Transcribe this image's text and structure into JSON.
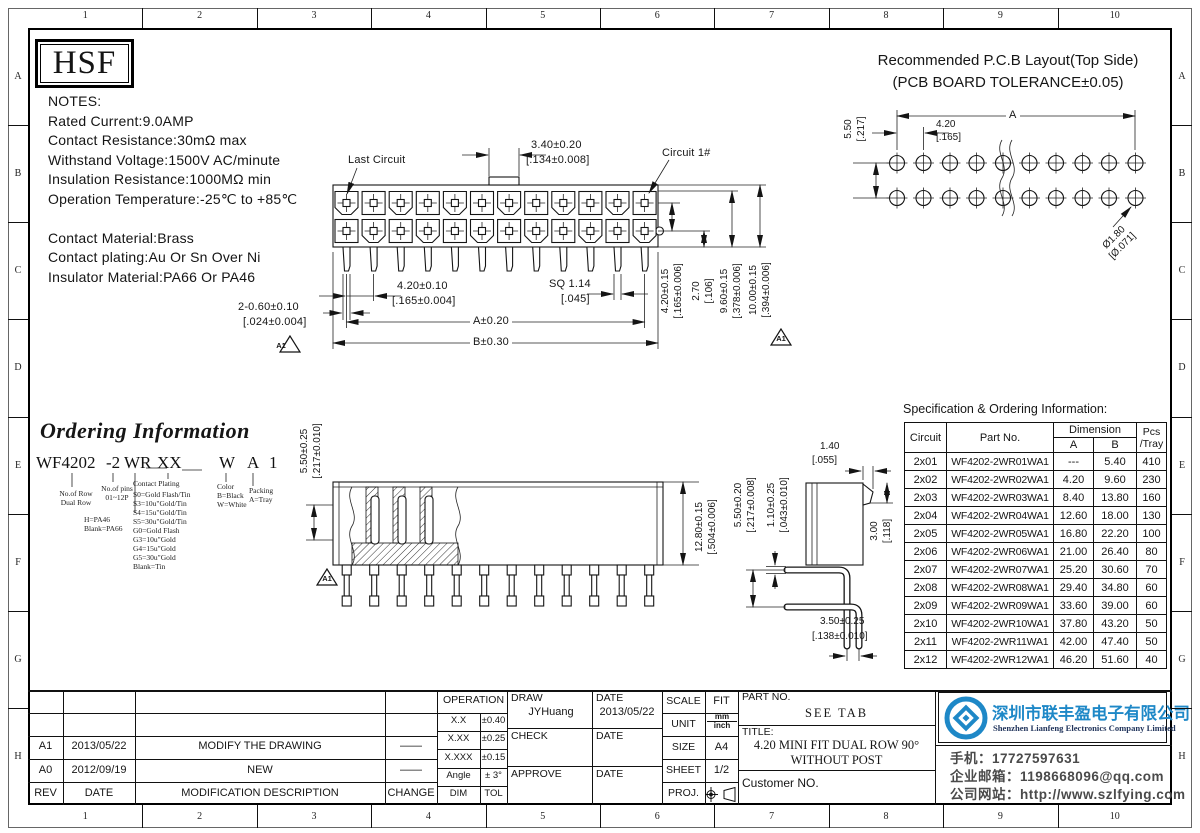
{
  "sheet": {
    "columns": [
      "1",
      "2",
      "3",
      "4",
      "5",
      "6",
      "7",
      "8",
      "9",
      "10"
    ],
    "rows": [
      "A",
      "B",
      "C",
      "D",
      "E",
      "F",
      "G",
      "H"
    ]
  },
  "logo_text": "HSF",
  "notes": {
    "lines": [
      "NOTES:",
      "Rated Current:9.0AMP",
      "Contact Resistance:30mΩ max",
      "Withstand Voltage:1500V AC/minute",
      "Insulation Resistance:1000MΩ min",
      "Operation Temperature:-25℃ to +85℃",
      "",
      "Contact Material:Brass",
      "Contact plating:Au Or Sn Over Ni",
      "Insulator Material:PA66 Or PA46"
    ]
  },
  "pcb": {
    "title_line1": "Recommended P.C.B Layout(Top Side)",
    "title_line2": "(PCB BOARD TOLERANCE±0.05)",
    "dim_v": "5.50",
    "dim_v_in": "[.217]",
    "dim_pitch": "4.20",
    "dim_pitch_in": "[.165]",
    "dim_a": "A",
    "dim_hole": "Ø1.80",
    "dim_hole_in": "[Ø.071]"
  },
  "front_view": {
    "last_circuit": "Last Circuit",
    "circuit1": "Circuit 1#",
    "dim_tab": "3.40±0.20",
    "dim_tab_in": "[.134±0.008]",
    "dim_pitch": "4.20±0.10",
    "dim_pitch_in": "[.165±0.004]",
    "dim_sq": "SQ 1.14",
    "dim_sq_in": "[.045]",
    "dim_a": "A±0.20",
    "dim_b": "B±0.30",
    "dim_pin": "2-0.60±0.10",
    "dim_pin_in": "[.024±0.004]",
    "rev_flag": "A1",
    "right_dims": [
      {
        "mm": "4.20±0.15",
        "in": "[.165±0.006]"
      },
      {
        "mm": "2.70",
        "in": "[.106]"
      },
      {
        "mm": "9.60±0.15",
        "in": "[.378±0.006]"
      },
      {
        "mm": "10.00±0.15",
        "in": "[.394±0.006]"
      }
    ]
  },
  "ordering": {
    "title": "Ordering Information",
    "code": [
      "WF4202",
      "-2",
      "WR",
      "XX",
      "W",
      "A",
      "1"
    ],
    "row_lines": [
      "No.of Row",
      "Dual Row"
    ],
    "pin_lines": [
      "No.of pins",
      "01~12P"
    ],
    "material_lines": [
      "H=PA46",
      "Blank=PA66"
    ],
    "plating_title": "Contact Plating",
    "plating_options": [
      "S0=Gold Flash/Tin",
      "S3=10u\"Gold/Tin",
      "S4=15u\"Gold/Tin",
      "S5=30u\"Gold/Tin",
      "G0=Gold Flash",
      "G3=10u\"Gold",
      "G4=15u\"Gold",
      "G5=30u\"Gold",
      "Blank=Tin"
    ],
    "color_lines": [
      "Color",
      "B=Black",
      "W=White"
    ],
    "packing_lines": [
      "Packing",
      "A=Tray"
    ]
  },
  "section_view": {
    "dim_h": "5.50±0.25",
    "dim_h_in": "[.217±0.010]",
    "dim_w": "12.80±0.15",
    "dim_w_in": "[.504±0.006]",
    "rev_flag": "A1"
  },
  "side_view": {
    "dim_top": "1.40",
    "dim_top_in": "[.055]",
    "dim_pin_space": "5.50±0.20",
    "dim_pin_space_in": "[.217±0.008]",
    "dim_pin_w": "1.10±0.25",
    "dim_pin_w_in": "[.043±0.010]",
    "dim_latch": "3.00",
    "dim_latch_in": "[.118]",
    "dim_bottom": "3.50±0.25",
    "dim_bottom_in": "[.138±0.010]"
  },
  "spec_table": {
    "title": "Specification & Ordering Information:",
    "col_circuit": "Circuit",
    "col_part": "Part No.",
    "col_dim": "Dimension",
    "col_a": "A",
    "col_b": "B",
    "col_pcs_1": "Pcs",
    "col_pcs_2": "/Tray",
    "rows": [
      [
        "2x01",
        "WF4202-2WR01WA1",
        "---",
        "5.40",
        "410"
      ],
      [
        "2x02",
        "WF4202-2WR02WA1",
        "4.20",
        "9.60",
        "230"
      ],
      [
        "2x03",
        "WF4202-2WR03WA1",
        "8.40",
        "13.80",
        "160"
      ],
      [
        "2x04",
        "WF4202-2WR04WA1",
        "12.60",
        "18.00",
        "130"
      ],
      [
        "2x05",
        "WF4202-2WR05WA1",
        "16.80",
        "22.20",
        "100"
      ],
      [
        "2x06",
        "WF4202-2WR06WA1",
        "21.00",
        "26.40",
        "80"
      ],
      [
        "2x07",
        "WF4202-2WR07WA1",
        "25.20",
        "30.60",
        "70"
      ],
      [
        "2x08",
        "WF4202-2WR08WA1",
        "29.40",
        "34.80",
        "60"
      ],
      [
        "2x09",
        "WF4202-2WR09WA1",
        "33.60",
        "39.00",
        "60"
      ],
      [
        "2x10",
        "WF4202-2WR10WA1",
        "37.80",
        "43.20",
        "50"
      ],
      [
        "2x11",
        "WF4202-2WR11WA1",
        "42.00",
        "47.40",
        "50"
      ],
      [
        "2x12",
        "WF4202-2WR12WA1",
        "46.20",
        "51.60",
        "40"
      ]
    ]
  },
  "title_block": {
    "revisions": {
      "headers": [
        "REV",
        "DATE",
        "MODIFICATION DESCRIPTION",
        "CHANGE"
      ],
      "rows": [
        [
          "A1",
          "2013/05/22",
          "MODIFY THE DRAWING",
          "——"
        ],
        [
          "A0",
          "2012/09/19",
          "NEW",
          "——"
        ]
      ]
    },
    "operation": {
      "title": "OPERATION",
      "rows": [
        [
          "X.X",
          "±0.40"
        ],
        [
          "X.XX",
          "±0.25"
        ],
        [
          "X.XXX",
          "±0.15"
        ],
        [
          "Angle",
          "± 3°"
        ],
        [
          "DIM",
          "TOL"
        ]
      ]
    },
    "signoff": {
      "draw_label": "DRAW",
      "draw_name": "JYHuang",
      "date_label": "DATE",
      "draw_date": "2013/05/22",
      "check_label": "CHECK",
      "approve_label": "APPROVE"
    },
    "info": {
      "scale_label": "SCALE",
      "scale": "FIT",
      "unit_label": "UNIT",
      "unit_top": "mm",
      "unit_bottom": "inch",
      "size_label": "SIZE",
      "size": "A4",
      "sheet_label": "SHEET",
      "sheet": "1/2",
      "proj_label": "PROJ."
    },
    "part": {
      "part_no_label": "PART NO.",
      "part_no": "SEE TAB",
      "title_label": "TITLE:",
      "title_line1": "4.20 MINI FIT DUAL ROW 90°",
      "title_line2": "WITHOUT POST",
      "customer_label": "Customer NO."
    },
    "company": {
      "name_cn": "深圳市联丰盈电子有限公司",
      "name_en": "Shenzhen Lianfeng Electronics Company Limited",
      "phone": "手机：17727597631",
      "email": "企业邮箱：1198668096@qq.com",
      "website": "公司网站：http://www.szlfying.com",
      "brand_color": "#1e88c7"
    }
  }
}
